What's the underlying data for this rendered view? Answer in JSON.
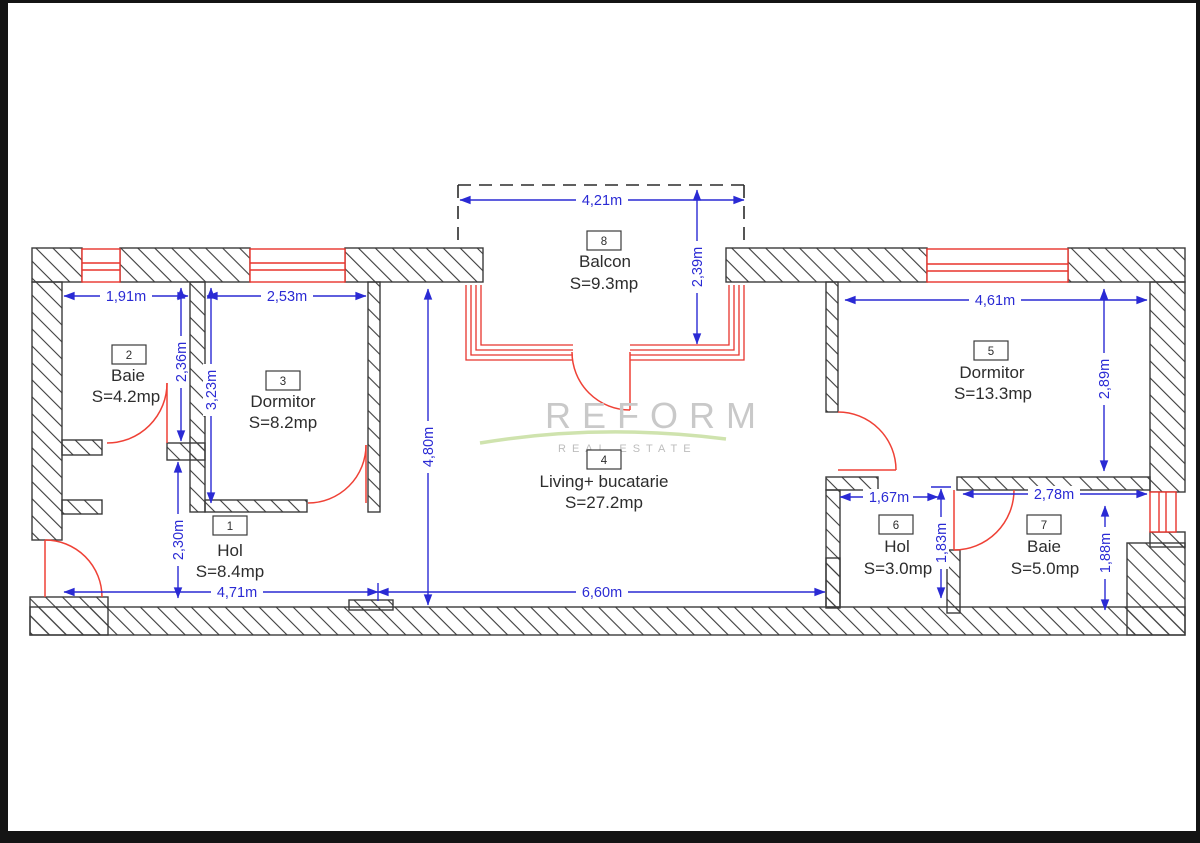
{
  "watermark": {
    "brand": "REFORM",
    "tagline": "REAL ESTATE"
  },
  "rooms": [
    {
      "number": "1",
      "name": "Hol",
      "area": "S=8.4mp"
    },
    {
      "number": "2",
      "name": "Baie",
      "area": "S=4.2mp"
    },
    {
      "number": "3",
      "name": "Dormitor",
      "area": "S=8.2mp"
    },
    {
      "number": "4",
      "name": "Living+ bucatarie",
      "area": "S=27.2mp"
    },
    {
      "number": "5",
      "name": "Dormitor",
      "area": "S=13.3mp"
    },
    {
      "number": "6",
      "name": "Hol",
      "area": "S=3.0mp"
    },
    {
      "number": "7",
      "name": "Baie",
      "area": "S=5.0mp"
    },
    {
      "number": "8",
      "name": "Balcon",
      "area": "S=9.3mp"
    }
  ],
  "dimensions": [
    {
      "id": "balcony-width",
      "label": "4,21m"
    },
    {
      "id": "balcony-depth",
      "label": "2,39m"
    },
    {
      "id": "baie2-width",
      "label": "1,91m"
    },
    {
      "id": "dormitor3-width",
      "label": "2,53m"
    },
    {
      "id": "baie2-depth",
      "label": "2,36m"
    },
    {
      "id": "dormitor3-depth",
      "label": "3,23m"
    },
    {
      "id": "hol1-depth",
      "label": "2,30m"
    },
    {
      "id": "living-depth",
      "label": "4,80m"
    },
    {
      "id": "hol1-width",
      "label": "4,71m"
    },
    {
      "id": "living-width",
      "label": "6,60m"
    },
    {
      "id": "dormitor5-width",
      "label": "4,61m"
    },
    {
      "id": "dormitor5-depth",
      "label": "2,89m"
    },
    {
      "id": "hol6-width",
      "label": "1,67m"
    },
    {
      "id": "hol6-depth",
      "label": "1,83m"
    },
    {
      "id": "baie7-width",
      "label": "2,78m"
    },
    {
      "id": "baie7-depth",
      "label": "1,88m"
    }
  ],
  "colors": {
    "wall_line": "#3b3b3b",
    "dimension_blue": "#2a2ad4",
    "opening_red": "#e8342c",
    "watermark_gray": "#c9c9c9",
    "watermark_green": "#cfe3ae",
    "frame_black": "#141414"
  }
}
